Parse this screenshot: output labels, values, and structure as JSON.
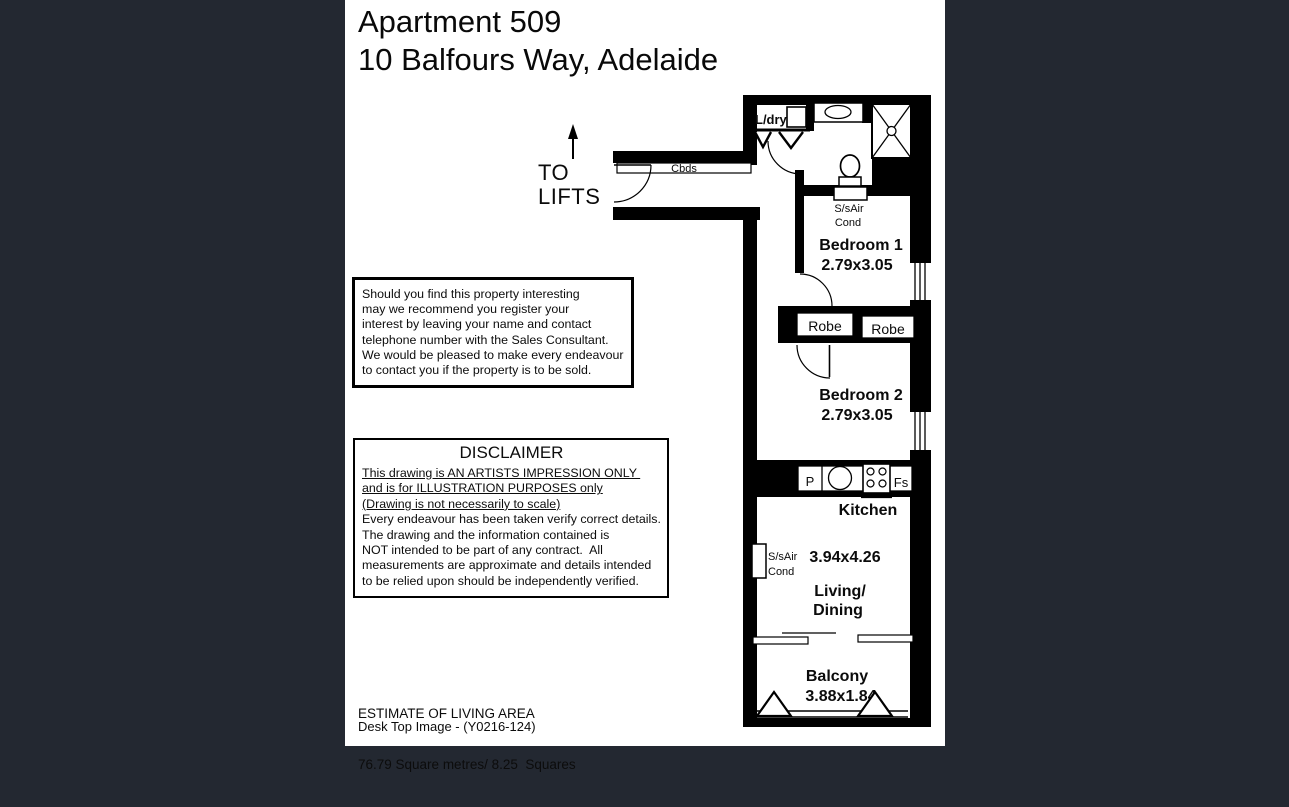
{
  "header": {
    "title_line1": "Apartment 509",
    "title_line2": "10 Balfours Way, Adelaide"
  },
  "to_lifts": {
    "line1": "TO",
    "line2": "LIFTS"
  },
  "interest_box": {
    "lines": [
      "Should you find this property interesting",
      "may we recommend you register your",
      "interest by leaving your name and contact",
      "telephone number with the Sales Consultant.",
      "We would be pleased to make every endeavour",
      "to contact you if the property is to be sold."
    ]
  },
  "disclaimer_box": {
    "heading": "DISCLAIMER",
    "underlined_lines": [
      "This drawing is AN ARTISTS IMPRESSION ONLY ",
      "and is for ILLUSTRATION PURPOSES only",
      "(Drawing is not necessarily to scale)"
    ],
    "lines": [
      "Every endeavour has been taken verify correct details.",
      "The drawing and the information contained is",
      "NOT intended to be part of any contract.  All",
      "measurements are approximate and details intended",
      "to be relied upon should be independently verified."
    ]
  },
  "estimate": {
    "line1": "ESTIMATE OF LIVING AREA",
    "line2": "76.79 Square metres/ 8.25  Squares"
  },
  "footer": {
    "reference": "Desk Top Image - (Y0216-124)"
  },
  "floorplan": {
    "labels": {
      "cbds": "Cbds",
      "ldry": "L/dry",
      "aircon1_line1": "S/sAir",
      "aircon1_line2": "Cond",
      "bedroom1_name": "Bedroom 1",
      "bedroom1_dims": "2.79x3.05",
      "robe_left": "Robe",
      "robe_right": "Robe",
      "bedroom2_name": "Bedroom 2",
      "bedroom2_dims": "2.79x3.05",
      "pantry": "P",
      "fridge": "Fs",
      "kitchen_name": "Kitchen",
      "living_dims": "3.94x4.26",
      "aircon2_line1": "S/sAir",
      "aircon2_line2": "Cond",
      "living_name_line1": "Living/",
      "living_name_line2": "Dining",
      "balcony_name": "Balcony",
      "balcony_dims": "3.88x1.84"
    },
    "colors": {
      "wall": "#000000",
      "floor": "#ffffff",
      "frame": "#232831"
    }
  }
}
